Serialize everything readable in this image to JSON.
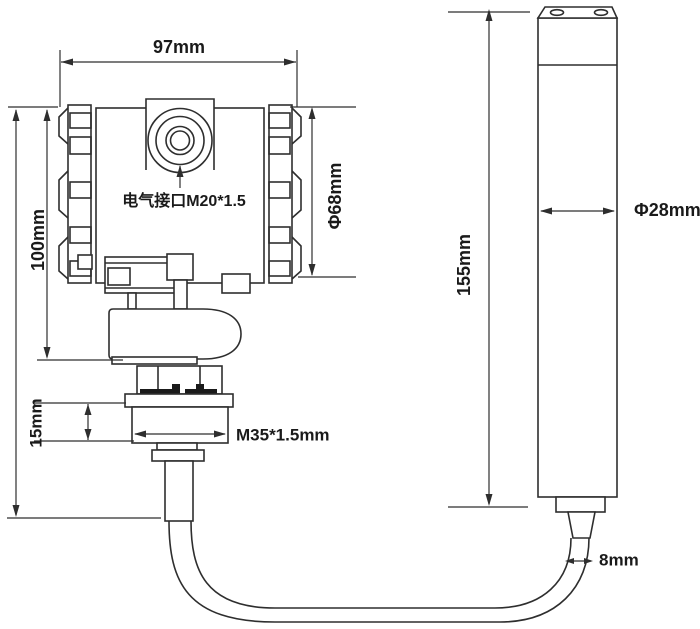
{
  "drawing": {
    "background": "#ffffff",
    "line_color": "#2e2e2e",
    "text_color": "#1a1a1a",
    "dims": {
      "housing_width": "97mm",
      "housing_height": "100mm",
      "housing_diameter": "Φ68mm",
      "electrical_port": "电气接口M20*1.5",
      "thread_section_height": "15mm",
      "thread_spec": "M35*1.5mm",
      "probe_length": "155mm",
      "probe_diameter": "Φ28mm",
      "cable_diameter": "8mm"
    }
  }
}
